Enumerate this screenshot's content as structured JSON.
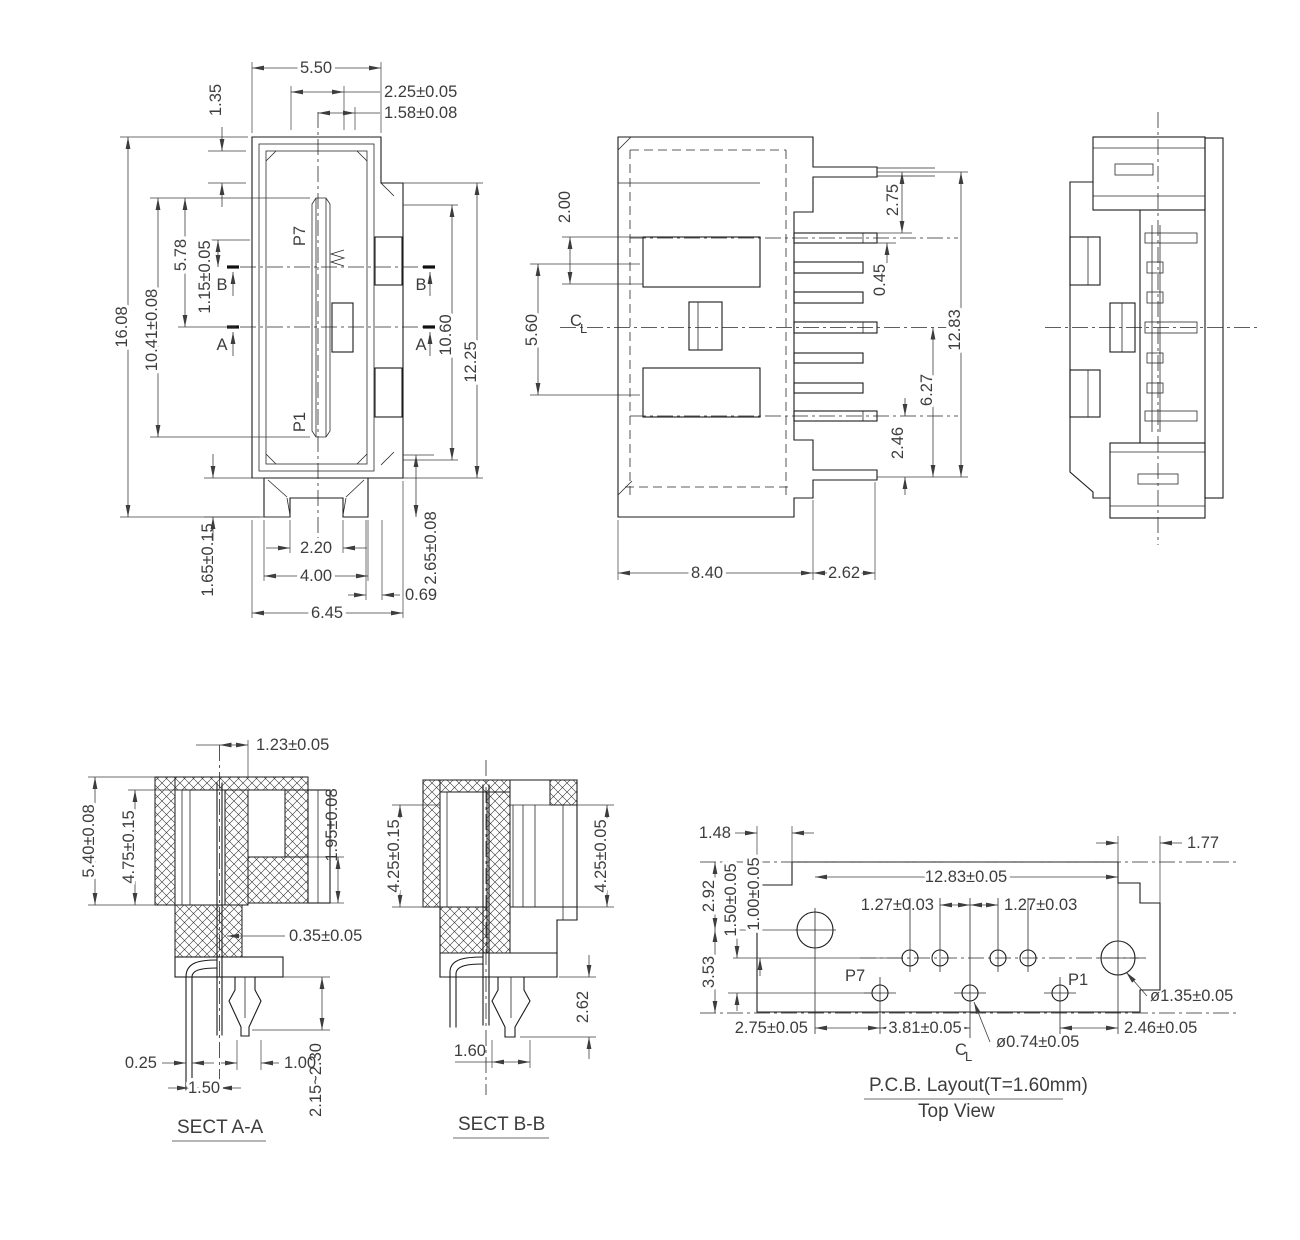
{
  "drawing": {
    "bg": "#ffffff",
    "line_color": "#1b1b1b",
    "dim_color": "#3d3d3d"
  },
  "front": {
    "p7": "P7",
    "p1": "P1",
    "sec_a": "A",
    "sec_b": "B",
    "top_width": "5.50",
    "slot_width": "2.25±0.05",
    "latch_offset": "1.58±0.08",
    "step": "1.35",
    "total_height": "16.08",
    "inner_height": "10.41±0.08",
    "upper_height": "5.78",
    "pin_offset": "1.15±0.05",
    "right_inner": "10.60",
    "right_height": "12.25",
    "flange_height": "1.65±0.15",
    "notch_width": "2.20",
    "flange_width": "4.00",
    "latch_bottom": "2.65±0.08",
    "gap": "0.69",
    "total_width": "6.45"
  },
  "side": {
    "post_step": "2.00",
    "slot_span": "5.60",
    "pin_top": "2.75",
    "pin_thick": "0.45",
    "total_span": "12.83",
    "pin_span": "6.27",
    "pin_bottom": "2.46",
    "body_width": "8.40",
    "post_width": "2.62",
    "cl_c": "C",
    "cl_l": "L"
  },
  "sect_a": {
    "title": "SECT A-A",
    "blade_offset": "1.23±0.05",
    "height": "5.40±0.08",
    "cavity_depth": "4.75±0.15",
    "shoulder": "1.95±0.08",
    "blade_thick": "0.35±0.05",
    "pin_width": "0.25",
    "pin_pitch": "1.50",
    "fork_width": "1.00",
    "tail": "2.15~2.30"
  },
  "sect_b": {
    "title": "SECT B-B",
    "depth_left": "4.25±0.15",
    "depth_right": "4.25±0.05",
    "tail": "2.62",
    "fork_width": "1.60"
  },
  "pcb": {
    "title": "P.C.B. Layout(T=1.60mm)",
    "subtitle": "Top View",
    "p7": "P7",
    "p1": "P1",
    "notch": "1.48",
    "edge": "1.77",
    "hole_span": "12.83±0.05",
    "pitch_l": "1.27±0.03",
    "pitch_r": "1.27±0.03",
    "row1": "2.92",
    "row2": "1.50±0.05",
    "row3": "1.00±0.05",
    "row4": "3.53",
    "d1": "2.75±0.05",
    "d2": "3.81±0.05",
    "hole_small": "ø0.74±0.05",
    "d3": "2.46±0.05",
    "hole_big": "ø1.35±0.05",
    "cl_c": "C",
    "cl_l": "L"
  }
}
